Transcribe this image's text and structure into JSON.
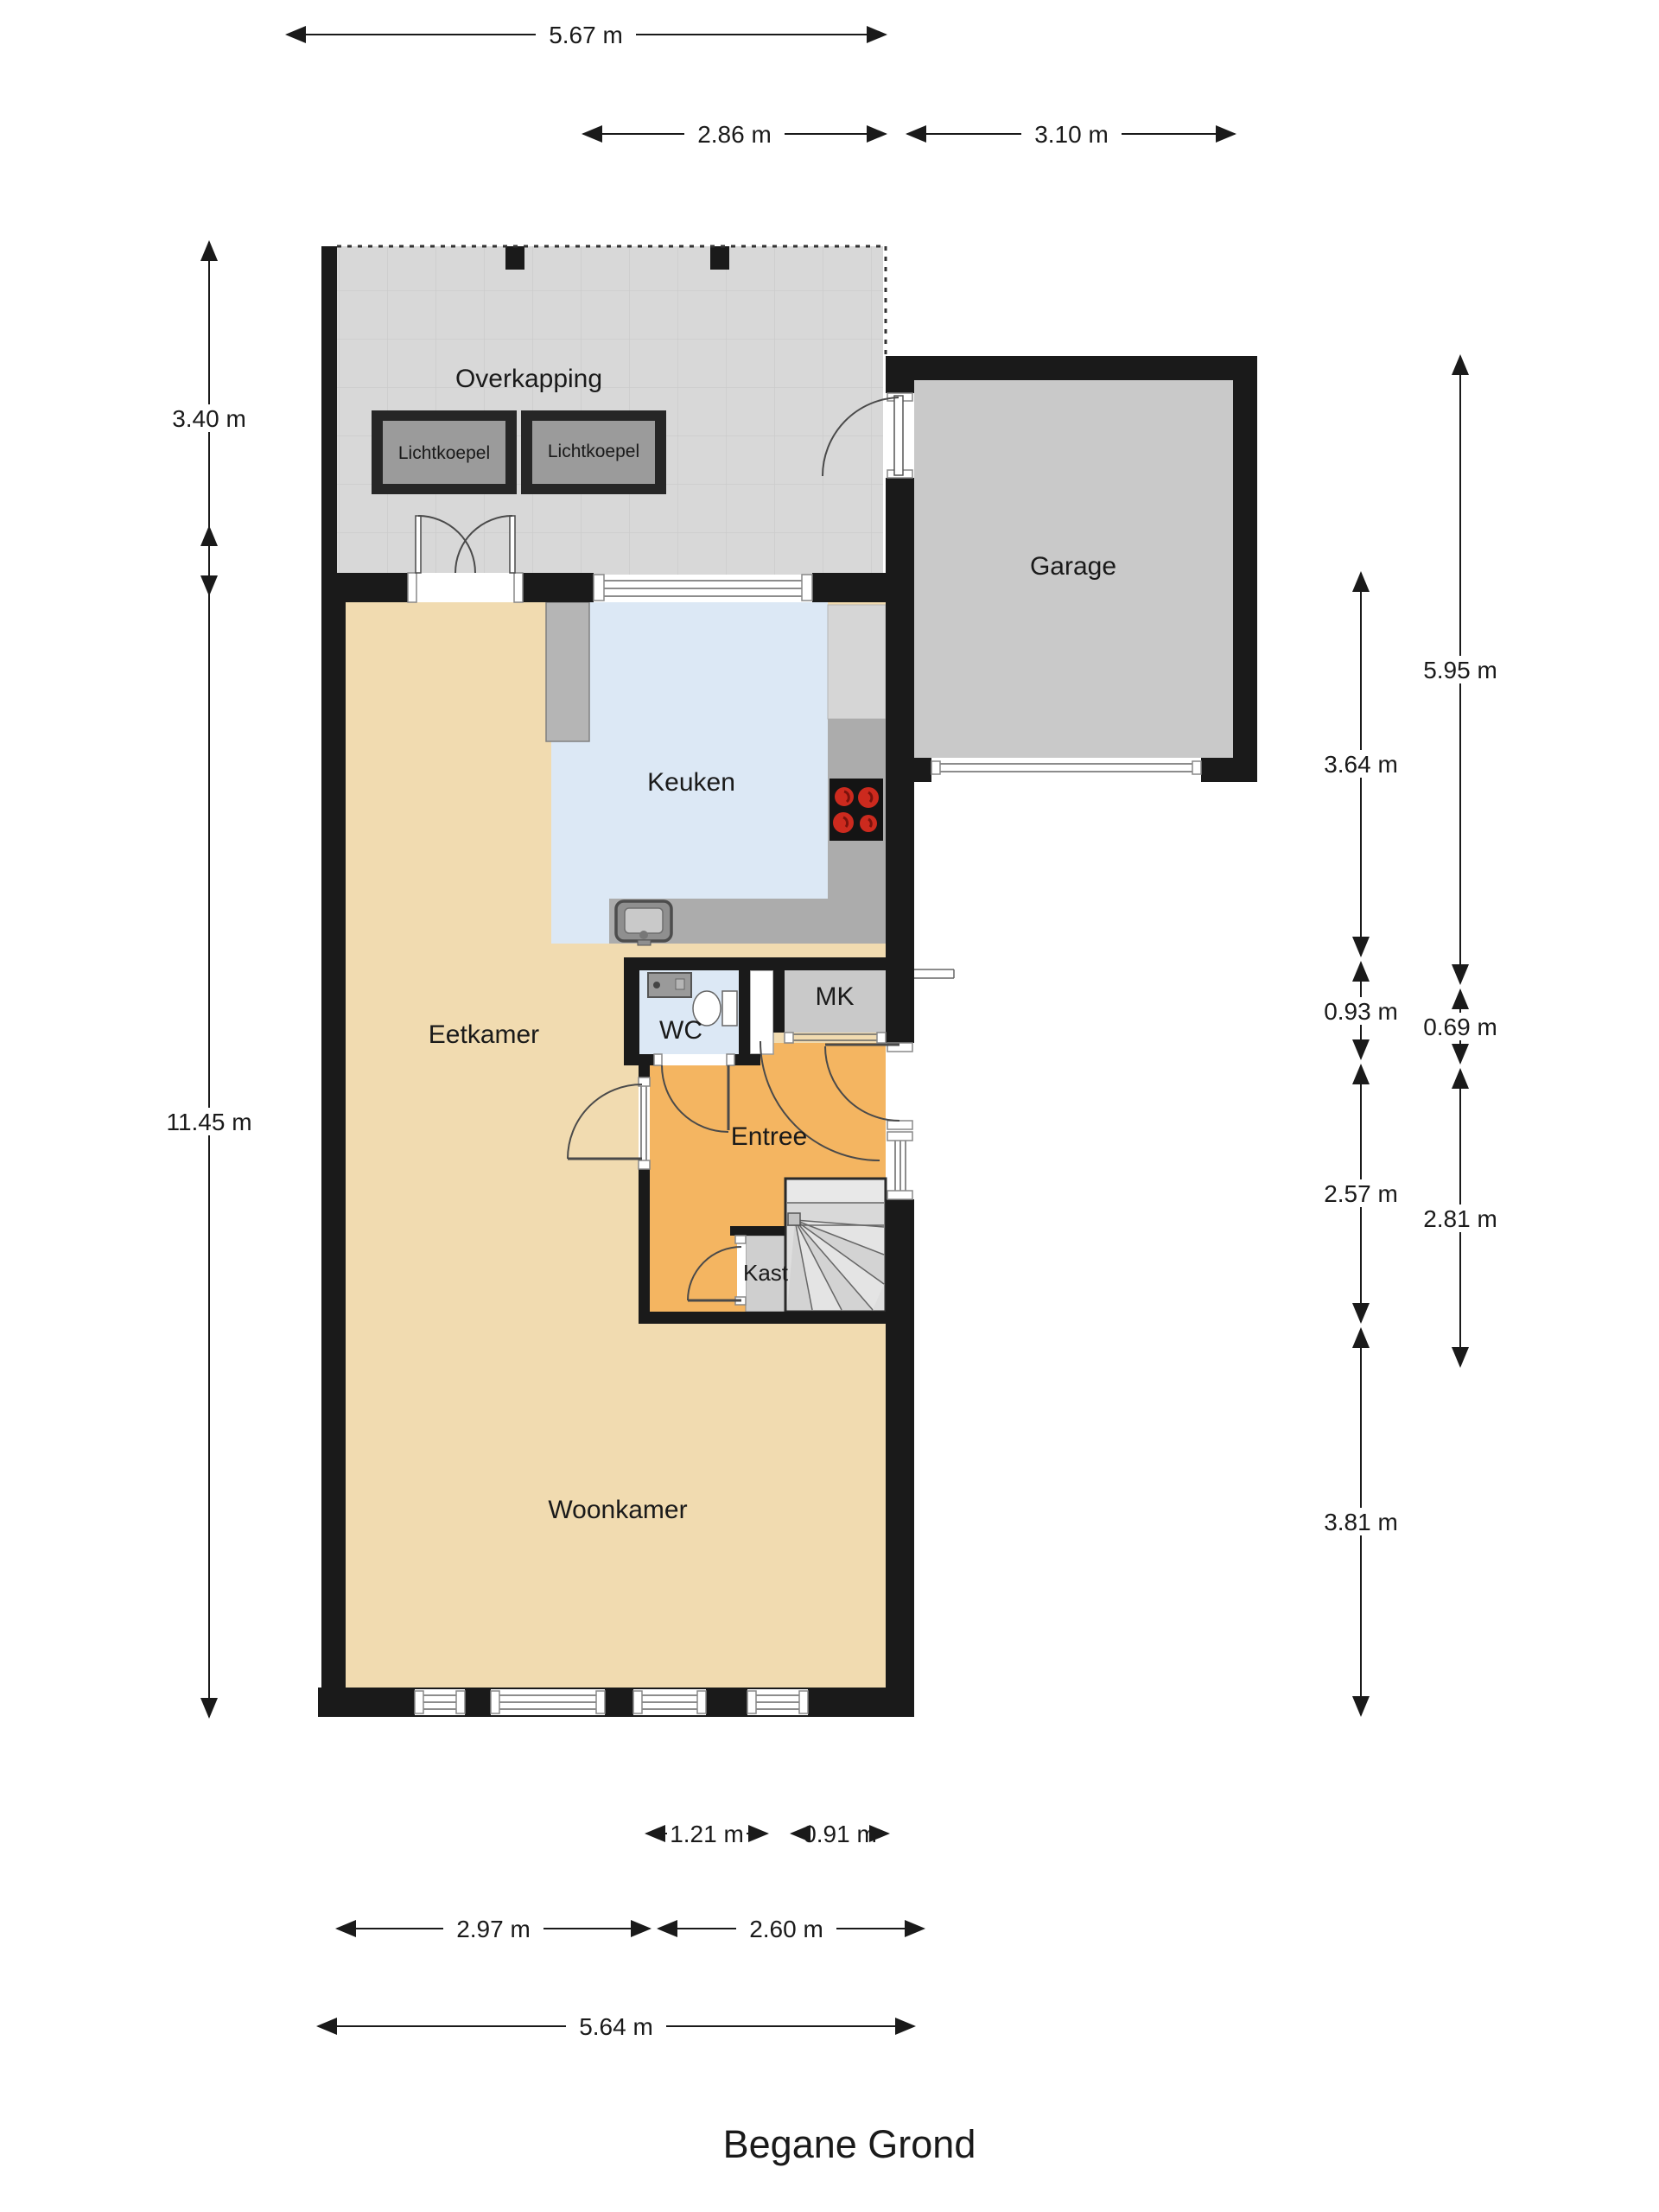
{
  "title": "Begane Grond",
  "rooms": {
    "overkapping": "Overkapping",
    "lichtkoepel_left": "Lichtkoepel",
    "lichtkoepel_right": "Lichtkoepel",
    "garage": "Garage",
    "keuken": "Keuken",
    "eetkamer": "Eetkamer",
    "wc": "WC",
    "mk": "MK",
    "entree": "Entree",
    "kast": "Kast",
    "woonkamer": "Woonkamer"
  },
  "dims": {
    "top_total": "5.67 m",
    "top_left": "2.86 m",
    "top_right": "3.10 m",
    "left_upper": "3.40 m",
    "left_lower": "11.45 m",
    "right_inner_1": "3.64 m",
    "right_inner_2": "0.93 m",
    "right_inner_3": "2.57 m",
    "right_inner_4": "3.81 m",
    "right_outer_1": "5.95 m",
    "right_outer_2": "0.69 m",
    "right_outer_3": "2.81 m",
    "bottom_small_left": "1.21 m",
    "bottom_small_right": "0.91 m",
    "bottom_mid_left": "2.97 m",
    "bottom_mid_right": "2.60 m",
    "bottom_total": "5.64 m"
  },
  "colors": {
    "wall": "#1a1a1a",
    "floor_living": "#f1dbb0",
    "floor_kitchen": "#dce8f5",
    "floor_entry": "#f4b561",
    "floor_garage": "#c9c9c9",
    "floor_canopy": "#d8d8d8",
    "floor_stairs": "#dedede",
    "counter": "#acacac",
    "accent_burner": "#cc2a1e"
  }
}
